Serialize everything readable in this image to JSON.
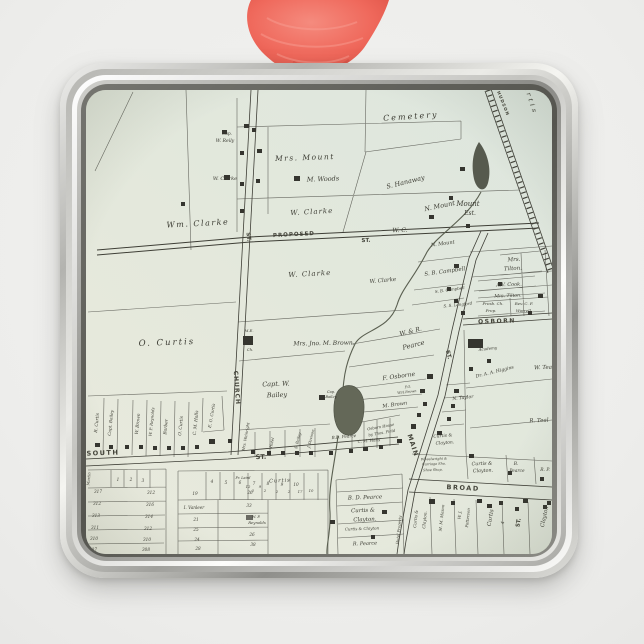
{
  "ornament": {
    "shape": "square-metal-frame-ornament",
    "ribbon_color": "#ed6356",
    "frame_highlight_color": "#fbfbf9",
    "frame_shadow_color": "#8f8f8b",
    "map_paper_color": "#e4e8dc",
    "map_ink_color": "#3c3c33",
    "background_color": "#f0f0ee"
  },
  "map": {
    "street_names": [
      "CHURCH ST.",
      "PROPOSED ST.",
      "SOUTH ST.",
      "MAIN ST.",
      "OSBORN",
      "BROAD",
      "HUDSON (railroad)"
    ],
    "labels": [
      {
        "t": "PROPOSED",
        "x": 294,
        "y": 236,
        "r": -3,
        "s": 5.5,
        "k": "st",
        "sp": 1
      },
      {
        "t": "ST.",
        "x": 366,
        "y": 242,
        "r": -2,
        "s": 5.5,
        "k": "st"
      },
      {
        "t": "ST.",
        "x": 247,
        "y": 237,
        "r": 84,
        "s": 5.5,
        "k": "st"
      },
      {
        "t": "CHURCH",
        "x": 235,
        "y": 388,
        "r": 86,
        "s": 6,
        "k": "st",
        "sp": 1
      },
      {
        "t": "SOUTH",
        "x": 103,
        "y": 455,
        "r": -2,
        "s": 6.5,
        "k": "st",
        "sp": 1.5
      },
      {
        "t": "ST.",
        "x": 261,
        "y": 459,
        "r": -2,
        "s": 6.5,
        "k": "st"
      },
      {
        "t": "MAIN",
        "x": 411,
        "y": 446,
        "r": 72,
        "s": 6.5,
        "k": "st",
        "sp": 1
      },
      {
        "t": "ST.",
        "x": 447,
        "y": 355,
        "r": 76,
        "s": 5.5,
        "k": "st"
      },
      {
        "t": "OSBORN",
        "x": 497,
        "y": 323,
        "r": -2,
        "s": 6,
        "k": "st",
        "sp": 1.5
      },
      {
        "t": "BROAD",
        "x": 463,
        "y": 490,
        "r": 3,
        "s": 6.5,
        "k": "st",
        "sp": 1.5
      },
      {
        "t": "HUDSON",
        "x": 502,
        "y": 104,
        "r": 68,
        "s": 4.2,
        "k": "st",
        "sp": 1
      },
      {
        "t": "ST.",
        "x": 520,
        "y": 523,
        "r": -80,
        "s": 5.5,
        "k": "st"
      },
      {
        "t": "Cemetery",
        "x": 411,
        "y": 119,
        "r": -4,
        "s": 8,
        "sp": 2
      },
      {
        "t": "S. Hanaway",
        "x": 406,
        "y": 184,
        "r": -14,
        "s": 6.5
      },
      {
        "t": "N. Mount",
        "x": 440,
        "y": 208,
        "r": -12,
        "s": 6.5
      },
      {
        "t": "Mount",
        "x": 468,
        "y": 206,
        "r": 0,
        "s": 7
      },
      {
        "t": "Est.",
        "x": 470,
        "y": 215,
        "r": 0,
        "s": 6
      },
      {
        "t": "N. Mount",
        "x": 443,
        "y": 245,
        "r": -8,
        "s": 5
      },
      {
        "t": "Cap.",
        "x": 227,
        "y": 135,
        "r": 0,
        "s": 4.2
      },
      {
        "t": "W. Reily",
        "x": 225,
        "y": 142,
        "r": 0,
        "s": 4.6
      },
      {
        "t": "W. Clarke",
        "x": 225,
        "y": 180,
        "r": 0,
        "s": 5
      },
      {
        "t": "Mrs. Mount",
        "x": 305,
        "y": 160,
        "r": -2,
        "s": 7.5,
        "sp": 1.5
      },
      {
        "t": "M. Woods",
        "x": 323,
        "y": 181,
        "r": -2,
        "s": 6.5
      },
      {
        "t": "W. Clarke",
        "x": 312,
        "y": 214,
        "r": -3,
        "s": 7,
        "sp": 1
      },
      {
        "t": "Wm. Clarke",
        "x": 198,
        "y": 226,
        "r": -3,
        "s": 8,
        "sp": 1.5
      },
      {
        "t": "W. C.",
        "x": 400,
        "y": 232,
        "r": -2,
        "s": 6
      },
      {
        "t": "W. Clarke",
        "x": 310,
        "y": 276,
        "r": -3,
        "s": 7,
        "sp": 1
      },
      {
        "t": "W. Clarke",
        "x": 383,
        "y": 282,
        "r": -5,
        "s": 5.5
      },
      {
        "t": "S. B. Campbell",
        "x": 445,
        "y": 273,
        "r": -8,
        "s": 5.5
      },
      {
        "t": "S. B. Campbell",
        "x": 450,
        "y": 291,
        "r": -8,
        "s": 4
      },
      {
        "t": "S. S. Langford",
        "x": 458,
        "y": 306,
        "r": -6,
        "s": 4
      },
      {
        "t": "Mrs.",
        "x": 514,
        "y": 261,
        "r": -3,
        "s": 5.5
      },
      {
        "t": "Tilton.",
        "x": 513,
        "y": 270,
        "r": -3,
        "s": 5.5
      },
      {
        "t": "A.V. Cook.",
        "x": 509,
        "y": 286,
        "r": -2,
        "s": 5
      },
      {
        "t": "Mrs. Tilton.",
        "x": 508,
        "y": 297,
        "r": -2,
        "s": 4.6
      },
      {
        "t": "Presb. Ch.",
        "x": 493,
        "y": 305,
        "r": 0,
        "s": 4
      },
      {
        "t": "Prop.",
        "x": 491,
        "y": 312,
        "r": 0,
        "s": 4
      },
      {
        "t": "Rev. C. F.",
        "x": 524,
        "y": 305,
        "r": 0,
        "s": 4
      },
      {
        "t": "Worrell.",
        "x": 524,
        "y": 312,
        "r": 0,
        "s": 4
      },
      {
        "t": "O. Curtis",
        "x": 167,
        "y": 345,
        "r": -2,
        "s": 8.5,
        "sp": 2
      },
      {
        "t": "M.E.",
        "x": 249,
        "y": 332,
        "r": 0,
        "s": 3.8
      },
      {
        "t": "Ch.",
        "x": 250,
        "y": 351,
        "r": 0,
        "s": 3.8
      },
      {
        "t": "Mrs. Jno. M. Brown.",
        "x": 324,
        "y": 345,
        "r": -1,
        "s": 6
      },
      {
        "t": "W. & R.",
        "x": 411,
        "y": 333,
        "r": -14,
        "s": 6
      },
      {
        "t": "Pearce",
        "x": 414,
        "y": 347,
        "r": -14,
        "s": 6.5
      },
      {
        "t": "Capt. W.",
        "x": 276,
        "y": 386,
        "r": -2,
        "s": 6.5
      },
      {
        "t": "Bailey",
        "x": 277,
        "y": 397,
        "r": -2,
        "s": 6.5
      },
      {
        "t": "Cap.",
        "x": 331,
        "y": 393,
        "r": 0,
        "s": 3.6
      },
      {
        "t": "Bailey",
        "x": 331,
        "y": 398,
        "r": 0,
        "s": 3.6
      },
      {
        "t": "F. Osborne",
        "x": 399,
        "y": 378,
        "r": -8,
        "s": 6
      },
      {
        "t": "F.O.",
        "x": 408,
        "y": 388,
        "r": -6,
        "s": 3.4
      },
      {
        "t": "W.H.Brown",
        "x": 407,
        "y": 393,
        "r": -6,
        "s": 3.4
      },
      {
        "t": "M. Brown",
        "x": 395,
        "y": 406,
        "r": -8,
        "s": 5
      },
      {
        "t": "N. Taylor",
        "x": 463,
        "y": 399,
        "r": -6,
        "s": 4.6
      },
      {
        "t": "Dr. A. A. Higgins",
        "x": 495,
        "y": 373,
        "r": -14,
        "s": 4.6
      },
      {
        "t": "Academy",
        "x": 488,
        "y": 350,
        "r": -6,
        "s": 4
      },
      {
        "t": "W. Teal",
        "x": 544,
        "y": 369,
        "r": -2,
        "s": 5.5
      },
      {
        "t": "R. Teal",
        "x": 539,
        "y": 422,
        "r": -2,
        "s": 5.5
      },
      {
        "t": "R. Curtis",
        "x": 98,
        "y": 423,
        "r": -84,
        "s": 4.4
      },
      {
        "t": "Capt. Bailey",
        "x": 112,
        "y": 423,
        "r": -84,
        "s": 4.2
      },
      {
        "t": "W. Brown",
        "x": 139,
        "y": 424,
        "r": -84,
        "s": 4.4
      },
      {
        "t": "W. P. Reynolds",
        "x": 153,
        "y": 422,
        "r": -84,
        "s": 4
      },
      {
        "t": "Barber",
        "x": 167,
        "y": 427,
        "r": -84,
        "s": 4.4
      },
      {
        "t": "O. Curtis",
        "x": 182,
        "y": 426,
        "r": -84,
        "s": 4.4
      },
      {
        "t": "C. M. Halls",
        "x": 197,
        "y": 423,
        "r": -84,
        "s": 4.4
      },
      {
        "t": "E. O. Curtis",
        "x": 213,
        "y": 416,
        "r": -80,
        "s": 4.2
      },
      {
        "t": "Mrs. Wainright",
        "x": 247,
        "y": 437,
        "r": -80,
        "s": 3.8
      },
      {
        "t": "Hotel",
        "x": 273,
        "y": 443,
        "r": -78,
        "s": 3.8
      },
      {
        "t": "S. Bailey",
        "x": 299,
        "y": 441,
        "r": -76,
        "s": 3.8
      },
      {
        "t": "J. Davison",
        "x": 312,
        "y": 439,
        "r": -76,
        "s": 3.8
      },
      {
        "t": "B.D. Pearce",
        "x": 344,
        "y": 438,
        "r": -5,
        "s": 4.2
      },
      {
        "t": "C. M. Halls",
        "x": 369,
        "y": 442,
        "r": -5,
        "s": 4
      },
      {
        "t": "Osborn House",
        "x": 381,
        "y": 428,
        "r": -10,
        "s": 3.8
      },
      {
        "t": "by Thos. Field",
        "x": 382,
        "y": 434,
        "r": -10,
        "s": 3.8
      },
      {
        "t": "Curtis &",
        "x": 443,
        "y": 437,
        "r": -5,
        "s": 4.4
      },
      {
        "t": "Clayton.",
        "x": 445,
        "y": 444,
        "r": -5,
        "s": 4.4
      },
      {
        "t": "Wheelwright &",
        "x": 434,
        "y": 460,
        "r": -2,
        "s": 3.4
      },
      {
        "t": "Carriage Sho.",
        "x": 434,
        "y": 465,
        "r": -2,
        "s": 3.4
      },
      {
        "t": "Shoe Shop.",
        "x": 433,
        "y": 471,
        "r": -2,
        "s": 3.4
      },
      {
        "t": "Curtis &",
        "x": 482,
        "y": 465,
        "r": -2,
        "s": 4.8
      },
      {
        "t": "Clayton.",
        "x": 483,
        "y": 472,
        "r": -2,
        "s": 4.8
      },
      {
        "t": "B.",
        "x": 516,
        "y": 465,
        "r": 0,
        "s": 4.4
      },
      {
        "t": "Pearce",
        "x": 517,
        "y": 472,
        "r": 0,
        "s": 4.4
      },
      {
        "t": "R. P.",
        "x": 545,
        "y": 471,
        "r": 0,
        "s": 4.4
      },
      {
        "t": "B. D. Pearce",
        "x": 365,
        "y": 499,
        "r": -2,
        "s": 5.5
      },
      {
        "t": "Curtis &",
        "x": 363,
        "y": 512,
        "r": -2,
        "s": 5.5
      },
      {
        "t": "Clayton.",
        "x": 365,
        "y": 521,
        "r": -2,
        "s": 5.5
      },
      {
        "t": "Curtis & Clayton",
        "x": 362,
        "y": 530,
        "r": -2,
        "s": 4
      },
      {
        "t": "R. Pearce",
        "x": 365,
        "y": 545,
        "r": -2,
        "s": 5
      },
      {
        "t": "Hotel Property",
        "x": 400,
        "y": 530,
        "r": -84,
        "s": 3.8
      },
      {
        "t": "Curtis &",
        "x": 417,
        "y": 519,
        "r": -84,
        "s": 4.2
      },
      {
        "t": "Clayton.",
        "x": 426,
        "y": 520,
        "r": -84,
        "s": 4.2
      },
      {
        "t": "M. M. Mason",
        "x": 443,
        "y": 518,
        "r": -84,
        "s": 4
      },
      {
        "t": "W. J.",
        "x": 461,
        "y": 515,
        "r": -84,
        "s": 4
      },
      {
        "t": "Patterson",
        "x": 469,
        "y": 518,
        "r": -84,
        "s": 4
      },
      {
        "t": "Curtis",
        "x": 492,
        "y": 518,
        "r": -80,
        "s": 5.5
      },
      {
        "t": "4",
        "x": 504,
        "y": 523,
        "r": -80,
        "s": 4.4
      },
      {
        "t": "Clayton",
        "x": 546,
        "y": 517,
        "r": -78,
        "s": 5.5
      },
      {
        "t": "urtis",
        "x": 529,
        "y": 101,
        "r": 72,
        "s": 6.5,
        "sp": 3
      },
      {
        "t": "Martin",
        "x": 90,
        "y": 479,
        "r": -84,
        "s": 3.8
      },
      {
        "t": "Fr. Laird",
        "x": 243,
        "y": 479,
        "r": 0,
        "s": 3.4
      },
      {
        "t": "Curtis",
        "x": 280,
        "y": 482,
        "r": -3,
        "s": 5,
        "sp": 1
      },
      {
        "t": "I. Vanleer",
        "x": 194,
        "y": 509,
        "r": 0,
        "s": 4.2
      },
      {
        "t": "W. P.",
        "x": 256,
        "y": 518,
        "r": 0,
        "s": 3.8
      },
      {
        "t": "Reynolds",
        "x": 257,
        "y": 524,
        "r": 0,
        "s": 3.8
      },
      {
        "t": "1",
        "x": 118,
        "y": 481,
        "k": "num",
        "s": 4.2
      },
      {
        "t": "2",
        "x": 131,
        "y": 481,
        "k": "num",
        "s": 4.2
      },
      {
        "t": "3",
        "x": 143,
        "y": 482,
        "k": "num",
        "s": 4.2
      },
      {
        "t": "4",
        "x": 212,
        "y": 483,
        "k": "num",
        "s": 4.2
      },
      {
        "t": "5",
        "x": 226,
        "y": 484,
        "k": "num",
        "s": 4.2
      },
      {
        "t": "6",
        "x": 240,
        "y": 484,
        "k": "num",
        "s": 4.2
      },
      {
        "t": "7",
        "x": 254,
        "y": 485,
        "k": "num",
        "s": 4.2
      },
      {
        "t": "8",
        "x": 268,
        "y": 485,
        "k": "num",
        "s": 4.2
      },
      {
        "t": "9",
        "x": 282,
        "y": 486,
        "k": "num",
        "s": 4.2
      },
      {
        "t": "10",
        "x": 296,
        "y": 486,
        "k": "num",
        "s": 4.2
      },
      {
        "t": "317",
        "x": 98,
        "y": 493,
        "k": "num",
        "s": 4.2
      },
      {
        "t": "312",
        "x": 97,
        "y": 505,
        "k": "num",
        "s": 4.2
      },
      {
        "t": "313",
        "x": 96,
        "y": 517,
        "k": "num",
        "s": 4.2
      },
      {
        "t": "311",
        "x": 95,
        "y": 529,
        "k": "num",
        "s": 4.2
      },
      {
        "t": "310",
        "x": 94,
        "y": 540,
        "k": "num",
        "s": 4.2
      },
      {
        "t": "307",
        "x": 93,
        "y": 551,
        "k": "num",
        "s": 4.2
      },
      {
        "t": "312",
        "x": 151,
        "y": 494,
        "k": "num",
        "s": 4.2
      },
      {
        "t": "316",
        "x": 150,
        "y": 506,
        "k": "num",
        "s": 4.2
      },
      {
        "t": "314",
        "x": 149,
        "y": 518,
        "k": "num",
        "s": 4.2
      },
      {
        "t": "312",
        "x": 148,
        "y": 530,
        "k": "num",
        "s": 4.2
      },
      {
        "t": "310",
        "x": 147,
        "y": 541,
        "k": "num",
        "s": 4.2
      },
      {
        "t": "308",
        "x": 146,
        "y": 551,
        "k": "num",
        "s": 4.2
      },
      {
        "t": "19",
        "x": 195,
        "y": 495,
        "k": "num",
        "s": 4.2
      },
      {
        "t": "21",
        "x": 196,
        "y": 521,
        "k": "num",
        "s": 4.2
      },
      {
        "t": "25",
        "x": 196,
        "y": 531,
        "k": "num",
        "s": 4.2
      },
      {
        "t": "24",
        "x": 197,
        "y": 541,
        "k": "num",
        "s": 4.2
      },
      {
        "t": "28",
        "x": 198,
        "y": 550,
        "k": "num",
        "s": 4.2
      },
      {
        "t": "26",
        "x": 250,
        "y": 494,
        "k": "num",
        "s": 4.2
      },
      {
        "t": "33",
        "x": 249,
        "y": 507,
        "k": "num",
        "s": 4.2
      },
      {
        "t": "26",
        "x": 252,
        "y": 536,
        "k": "num",
        "s": 4.2
      },
      {
        "t": "38",
        "x": 253,
        "y": 546,
        "k": "num",
        "s": 4.2
      },
      {
        "t": "12",
        "x": 248,
        "y": 488,
        "k": "num",
        "s": 3.8
      },
      {
        "t": "9",
        "x": 260,
        "y": 488,
        "k": "num",
        "s": 3.8
      },
      {
        "t": "2",
        "x": 253,
        "y": 492,
        "k": "num",
        "s": 3.8
      },
      {
        "t": "2",
        "x": 265,
        "y": 492,
        "k": "num",
        "s": 3.8
      },
      {
        "t": "2",
        "x": 277,
        "y": 493,
        "k": "num",
        "s": 3.8
      },
      {
        "t": "2",
        "x": 289,
        "y": 493,
        "k": "num",
        "s": 3.8
      },
      {
        "t": "17",
        "x": 300,
        "y": 493,
        "k": "num",
        "s": 3.8
      },
      {
        "t": "10",
        "x": 311,
        "y": 492,
        "k": "num",
        "s": 3.8
      }
    ]
  }
}
